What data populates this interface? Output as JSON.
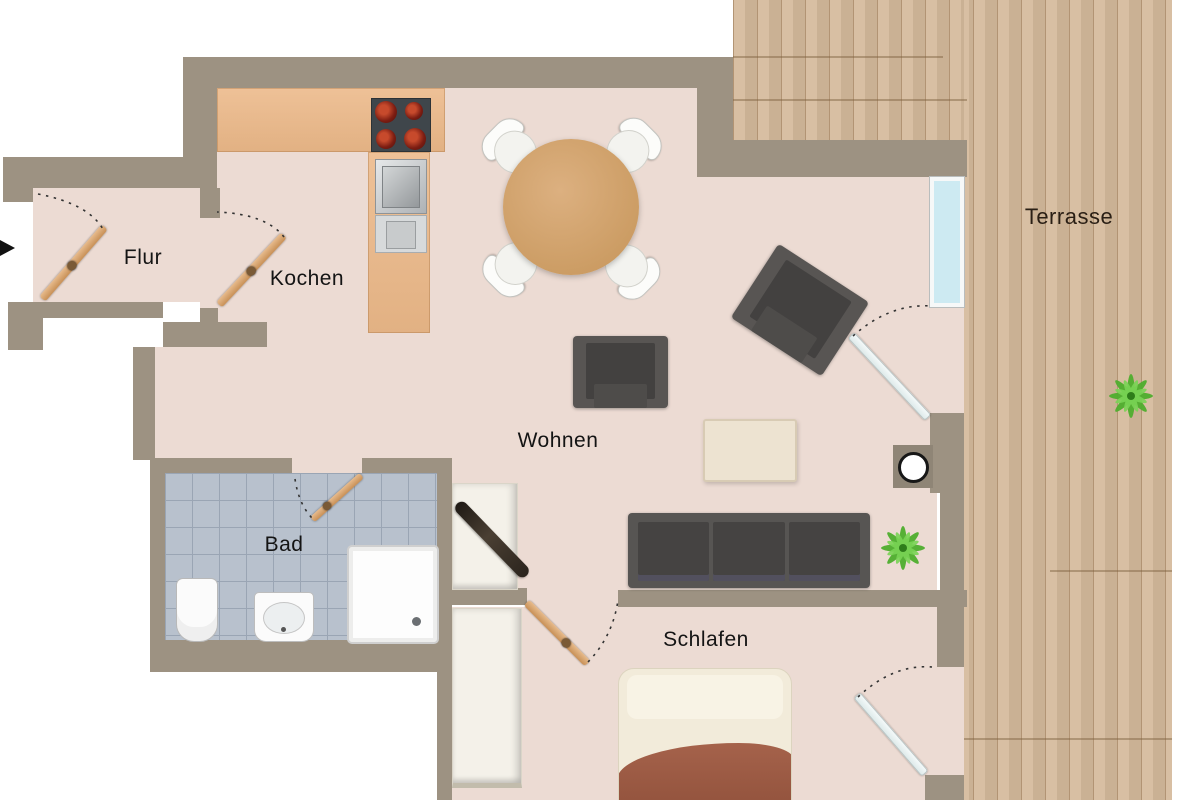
{
  "rooms": {
    "flur": {
      "label": "Flur"
    },
    "kochen": {
      "label": "Kochen"
    },
    "wohnen": {
      "label": "Wohnen"
    },
    "bad": {
      "label": "Bad"
    },
    "schlafen": {
      "label": "Schlafen"
    },
    "terrasse": {
      "label": "Terrasse"
    }
  },
  "colors": {
    "wall": "#9d9282",
    "floor": "#ecdbd3",
    "terrace_wood": "#d5ba9c",
    "kitchen_counter_wood": "#e9bd92",
    "table_wood": "#d2a172",
    "dark_furniture": "#545250",
    "bath_tiles": "#b8c1cd",
    "window_glass": "#cdeaf2",
    "plant_green": "#4fae2e",
    "bed_blanket": "#a5624b",
    "stove_burner": "#8a2217"
  },
  "fixtures": [
    "entrance-arrow",
    "door",
    "door-swing-arc",
    "window",
    "kitchen-counter",
    "stove",
    "sink",
    "dishwasher",
    "dining-table",
    "dining-chair",
    "armchair",
    "sofa",
    "coffee-table",
    "sideboard",
    "pedestal-lamp",
    "plant",
    "toilet",
    "bidet",
    "shower",
    "bed",
    "wardrobe"
  ]
}
